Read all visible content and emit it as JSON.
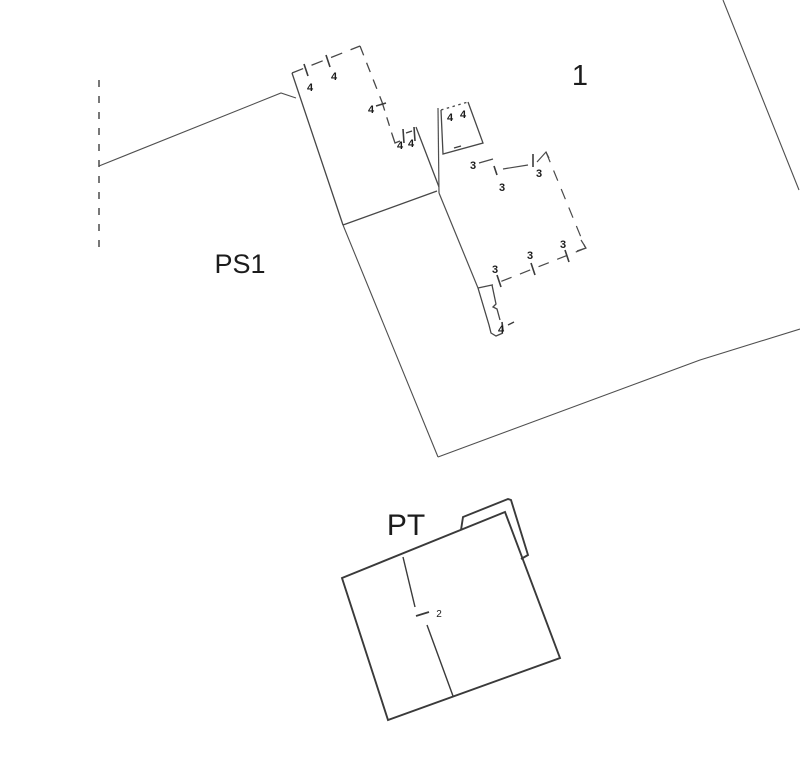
{
  "page": {
    "background": "#ffffff",
    "title": "cadastral plan"
  },
  "plan": {
    "canvas": {
      "width": 800,
      "height": 773
    },
    "line_color": "#4f4f4f",
    "building_line_color": "#474747",
    "pt_line_color": "#3a3a3a",
    "text_color": "#1c1c1c",
    "region_labels": [
      {
        "name": "label-parcel-1",
        "text": "1",
        "x": 580,
        "y": 85,
        "size": 29,
        "weight": 400
      },
      {
        "name": "label-ps1",
        "text": "PS1",
        "x": 240,
        "y": 273,
        "size": 27,
        "weight": 400
      },
      {
        "name": "label-pt",
        "text": "PT",
        "x": 406,
        "y": 535,
        "size": 30,
        "weight": 400
      }
    ],
    "point_labels": [
      {
        "name": "dim-4-top-1",
        "text": "4",
        "x": 310,
        "y": 91,
        "size": 11,
        "weight": 700
      },
      {
        "name": "dim-4-top-2",
        "text": "4",
        "x": 334,
        "y": 80,
        "size": 11,
        "weight": 700
      },
      {
        "name": "dim-4-right-1",
        "text": "4",
        "x": 371,
        "y": 113,
        "size": 11,
        "weight": 700
      },
      {
        "name": "dim-4-step-1",
        "text": "4",
        "x": 400,
        "y": 149,
        "size": 11,
        "weight": 700
      },
      {
        "name": "dim-4-step-2",
        "text": "4",
        "x": 411,
        "y": 147,
        "size": 11,
        "weight": 700
      },
      {
        "name": "dim-4-annex-1",
        "text": "4",
        "x": 450,
        "y": 121,
        "size": 11,
        "weight": 700
      },
      {
        "name": "dim-4-annex-2",
        "text": "4",
        "x": 463,
        "y": 118,
        "size": 11,
        "weight": 700
      },
      {
        "name": "dim-4-stub",
        "text": "4",
        "x": 501,
        "y": 333,
        "size": 11,
        "weight": 700
      },
      {
        "name": "dim-3-top-1",
        "text": "3",
        "x": 473,
        "y": 169,
        "size": 11,
        "weight": 700
      },
      {
        "name": "dim-3-top-2",
        "text": "3",
        "x": 502,
        "y": 191,
        "size": 11,
        "weight": 700
      },
      {
        "name": "dim-3-top-3",
        "text": "3",
        "x": 539,
        "y": 177,
        "size": 11,
        "weight": 700
      },
      {
        "name": "dim-3-bot-1",
        "text": "3",
        "x": 495,
        "y": 273,
        "size": 11,
        "weight": 700
      },
      {
        "name": "dim-3-bot-2",
        "text": "3",
        "x": 530,
        "y": 259,
        "size": 11,
        "weight": 700
      },
      {
        "name": "dim-3-bot-3",
        "text": "3",
        "x": 563,
        "y": 248,
        "size": 11,
        "weight": 700
      },
      {
        "name": "dim-2-pt",
        "text": "2",
        "x": 439,
        "y": 617,
        "size": 10,
        "weight": 400
      }
    ],
    "shapes": [
      {
        "name": "survey-dashed-line",
        "d": "M99,80 L99,252",
        "dash": "7 9",
        "width": 1.6,
        "color": "#565656"
      },
      {
        "name": "boundary-west-line",
        "d": "M99,166 L281,93 L296,98",
        "width": 1.1
      },
      {
        "name": "parcel-west-edge",
        "d": "M343,225 L438,457",
        "width": 1.1
      },
      {
        "name": "parcel-south-edge",
        "d": "M438,457 L700,360 L800,329",
        "width": 1.1
      },
      {
        "name": "parcel-east-edge",
        "d": "M723,0 L799,190",
        "width": 1.1
      },
      {
        "name": "main-building-left-wall",
        "d": "M292,73 L343,225",
        "width": 1.3,
        "color": "#474747"
      },
      {
        "name": "main-building-bottom-wall",
        "d": "M343,225 L437,191",
        "width": 1.3,
        "color": "#474747"
      },
      {
        "name": "main-building-top-wall",
        "d": "M292,73 L360,46",
        "dash": "12 9",
        "width": 1.3,
        "color": "#474747"
      },
      {
        "name": "main-building-right-wall-a",
        "d": "M360,46 L382,102",
        "dash": "10 8",
        "width": 1.3,
        "color": "#474747"
      },
      {
        "name": "main-building-right-wall-b",
        "d": "M382,102 L392,134",
        "dash": "9 7",
        "width": 1.3,
        "color": "#474747"
      },
      {
        "name": "main-building-step",
        "d": "M392,134 L395,143 L400,141",
        "width": 1.3,
        "color": "#474747"
      },
      {
        "name": "main-building-right-wall-c",
        "d": "M416,127 L439,187",
        "width": 1.3,
        "color": "#474747"
      },
      {
        "name": "tick-top-1",
        "d": "M304,64 L308,76",
        "width": 1.6,
        "color": "#3c3c3c"
      },
      {
        "name": "tick-top-2",
        "d": "M326,55 L330,67",
        "width": 1.6,
        "color": "#3c3c3c"
      },
      {
        "name": "tick-right-1",
        "d": "M376,106 L386,103",
        "width": 1.6,
        "color": "#3c3c3c"
      },
      {
        "name": "tick-step-1",
        "d": "M403,129 L404,143",
        "width": 1.6,
        "color": "#3c3c3c"
      },
      {
        "name": "tick-step-dash",
        "d": "M406,133 L412,131",
        "width": 1.4,
        "color": "#3c3c3c"
      },
      {
        "name": "tick-step-2",
        "d": "M414,127 L415,141",
        "width": 1.6,
        "color": "#3c3c3c"
      },
      {
        "name": "annex-outline",
        "d": "M468,102 L483,143 L443,154 L441,110",
        "width": 1.3,
        "color": "#474747"
      },
      {
        "name": "annex-top-dotted",
        "d": "M441,110 L468,102",
        "dash": "2.5 3.5",
        "width": 1.3,
        "color": "#474747"
      },
      {
        "name": "annex-west-line",
        "d": "M438,108 L439,193",
        "width": 1.2
      },
      {
        "name": "annex-bottom-dash",
        "d": "M454,148 L461,146",
        "width": 1.4,
        "color": "#3c3c3c"
      },
      {
        "name": "interior-diagonal-line",
        "d": "M439,193 L478,288",
        "width": 1.2
      },
      {
        "name": "room3-top-wall-a",
        "d": "M479,163 L493,159",
        "width": 1.2,
        "color": "#4a4a4a"
      },
      {
        "name": "room3-top-wall-b",
        "d": "M503,169 L528,165",
        "width": 1.2,
        "color": "#4a4a4a"
      },
      {
        "name": "room3-top-right-corner",
        "d": "M537,162 L546,152 L549,158",
        "width": 1.2,
        "color": "#4a4a4a"
      },
      {
        "name": "room3-right-wall",
        "d": "M546,152 L585,247",
        "dash": "11 9",
        "width": 1.2,
        "color": "#4a4a4a"
      },
      {
        "name": "room3-bottom-right-corner",
        "d": "M581,240 L586,248 L577,251",
        "width": 1.2,
        "color": "#4a4a4a"
      },
      {
        "name": "room3-bottom-wall",
        "d": "M586,248 L492,285",
        "dash": "11 9",
        "width": 1.2,
        "color": "#4a4a4a"
      },
      {
        "name": "room3-bottom-left-link",
        "d": "M492,285 L478,288",
        "width": 1.2,
        "color": "#4a4a4a"
      },
      {
        "name": "room3-tick-top-1",
        "d": "M494,166 L497,175",
        "width": 1.6,
        "color": "#3c3c3c"
      },
      {
        "name": "room3-tick-top-2",
        "d": "M533,154 L533,167",
        "width": 1.6,
        "color": "#3c3c3c"
      },
      {
        "name": "room3-tick-bot-1",
        "d": "M497,275 L501,287",
        "width": 1.6,
        "color": "#3c3c3c"
      },
      {
        "name": "room3-tick-bot-2",
        "d": "M531,263 L535,275",
        "width": 1.6,
        "color": "#3c3c3c"
      },
      {
        "name": "room3-tick-bot-3",
        "d": "M565,250 L569,262",
        "width": 1.6,
        "color": "#3c3c3c"
      },
      {
        "name": "stub-right-side",
        "d": "M492,285 L496,304 L493,307 L497,309 L500,320",
        "width": 1.3,
        "color": "#474747"
      },
      {
        "name": "stub-tick",
        "d": "M502,322 L503,331",
        "width": 1.6,
        "color": "#3c3c3c"
      },
      {
        "name": "stub-dash",
        "d": "M508,325 L514,322",
        "width": 1.4,
        "color": "#3c3c3c"
      },
      {
        "name": "stub-left-bottom",
        "d": "M478,288 L489,325 L491,333 L496,336 L503,333",
        "width": 1.3,
        "color": "#474747"
      },
      {
        "name": "pt-building-outline",
        "d": "M342,578 L505,512 L560,658 L388,720 Z",
        "width": 1.9,
        "color": "#3a3a3a"
      },
      {
        "name": "pt-annex-outline",
        "d": "M461,530 L463,517 L508,499 L511,500 L528,555 L521,559",
        "width": 1.9,
        "color": "#3a3a3a"
      },
      {
        "name": "pt-divider-upper",
        "d": "M403,557 L415,607",
        "width": 1.4,
        "color": "#3a3a3a"
      },
      {
        "name": "pt-divider-lower",
        "d": "M427,625 L453,696",
        "width": 1.4,
        "color": "#3a3a3a"
      },
      {
        "name": "pt-divider-tick",
        "d": "M416,616 L429,612",
        "width": 1.8,
        "color": "#3a3a3a"
      }
    ]
  }
}
